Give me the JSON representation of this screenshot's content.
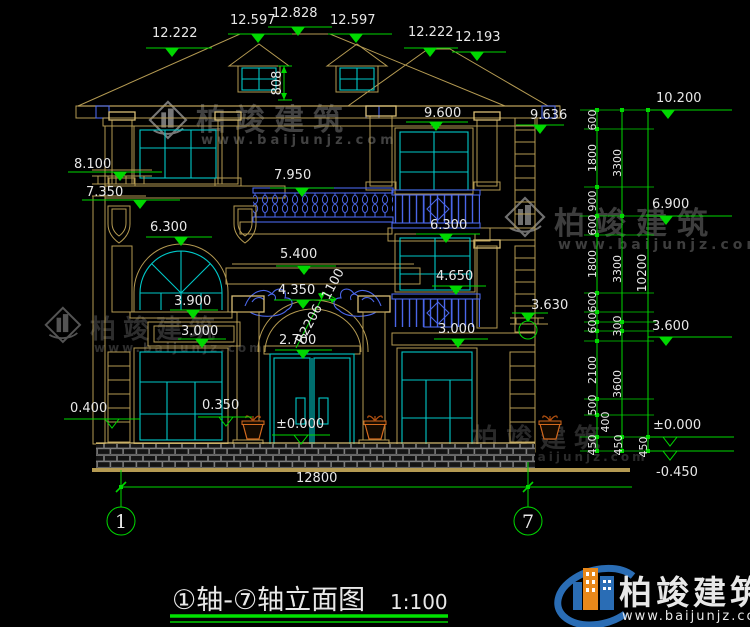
{
  "title_block": {
    "title": "①轴-⑦轴立面图",
    "scale": "1:100"
  },
  "axis_bubbles": [
    "1",
    "7"
  ],
  "top_elevations": [
    "12.222",
    "12.597",
    "12.828",
    "12.597",
    "12.222",
    "12.193"
  ],
  "left_elevations": [
    "8.100",
    "7.350",
    "6.300",
    "3.900",
    "3.000",
    "0.400",
    "0.350"
  ],
  "right_facade_elevations": [
    "9.600",
    "9.636",
    "6.300",
    "4.650",
    "3.000",
    "3.630"
  ],
  "annotations": {
    "dormer_height": "808",
    "terrace": "7.950",
    "portico_top": "5.400",
    "arch_crown": "4.350",
    "arch_width": "1100",
    "arch_radius": "R2206",
    "door_top": "2.700",
    "entry_level": "±0.000"
  },
  "datum_elevations": [
    "10.200",
    "6.900",
    "3.600",
    "±0.000",
    "-0.450"
  ],
  "dim_chain_detail": [
    "600",
    "1800",
    "900",
    "600",
    "1800",
    "600",
    "600",
    "2100",
    "500",
    "400",
    "450"
  ],
  "dim_chain_floors": [
    "3300",
    "3300",
    "300",
    "3600",
    "450"
  ],
  "dim_chain_total": [
    "10200",
    "450"
  ],
  "overall_width": "12800",
  "brand": {
    "name": "柏竣建筑",
    "url": "www.baijunjz.com"
  }
}
